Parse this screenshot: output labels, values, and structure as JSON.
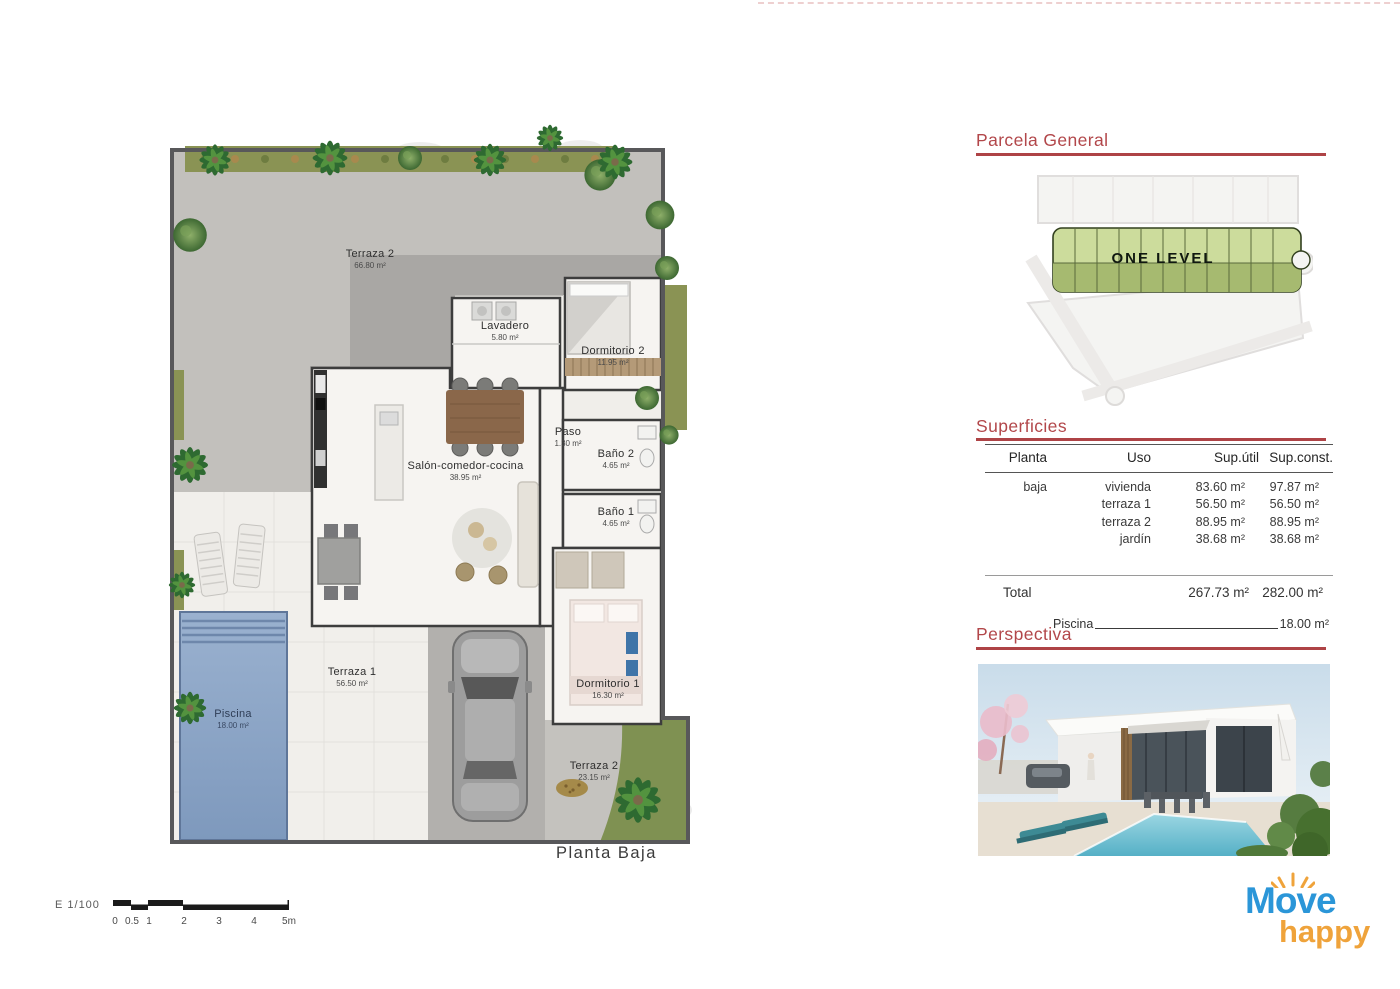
{
  "accent": "#b2474a",
  "plan": {
    "caption": "Planta Baja",
    "rooms": {
      "terraza2_top": {
        "name": "Terraza 2",
        "area": "66.80 m²"
      },
      "lavadero": {
        "name": "Lavadero",
        "area": "5.80 m²"
      },
      "dormitorio2": {
        "name": "Dormitorio 2",
        "area": "11.95 m²"
      },
      "salon": {
        "name": "Salón-comedor-cocina",
        "area": "38.95 m²"
      },
      "paso": {
        "name": "Paso",
        "area": "1.30 m²"
      },
      "bano2": {
        "name": "Baño 2",
        "area": "4.65 m²"
      },
      "bano1": {
        "name": "Baño 1",
        "area": "4.65 m²"
      },
      "dormitorio1": {
        "name": "Dormitorio 1",
        "area": "16.30 m²"
      },
      "terraza1": {
        "name": "Terraza 1",
        "area": "56.50 m²"
      },
      "piscina": {
        "name": "Piscina",
        "area": "18.00 m²"
      },
      "terraza2_bottom": {
        "name": "Terraza 2",
        "area": "23.15 m²"
      }
    },
    "scalebar": {
      "label": "E 1/100",
      "ticks": [
        "0",
        "0.5",
        "1",
        "2",
        "3",
        "4",
        "5m"
      ]
    }
  },
  "parcela": {
    "heading": "Parcela General",
    "plot_label": "ONE LEVEL"
  },
  "superficies": {
    "heading": "Superficies",
    "columns": [
      "Planta",
      "Uso",
      "Sup.útil",
      "Sup.const."
    ],
    "rows": [
      {
        "planta": "baja",
        "uso": "vivienda",
        "util": "83.60 m²",
        "const": "97.87 m²"
      },
      {
        "planta": "",
        "uso": "terraza 1",
        "util": "56.50 m²",
        "const": "56.50 m²"
      },
      {
        "planta": "",
        "uso": "terraza 2",
        "util": "88.95 m²",
        "const": "88.95 m²"
      },
      {
        "planta": "",
        "uso": "jardín",
        "util": "38.68 m²",
        "const": "38.68 m²"
      }
    ],
    "total_label": "Total",
    "total_util": "267.73 m²",
    "total_const": "282.00 m²",
    "piscina_label": "Piscina",
    "piscina_value": "18.00 m²"
  },
  "perspectiva": {
    "heading": "Perspectiva"
  },
  "logo": {
    "word1": "Move",
    "word2": "happy",
    "blue": "#2b96d8",
    "orange": "#efa33b"
  }
}
